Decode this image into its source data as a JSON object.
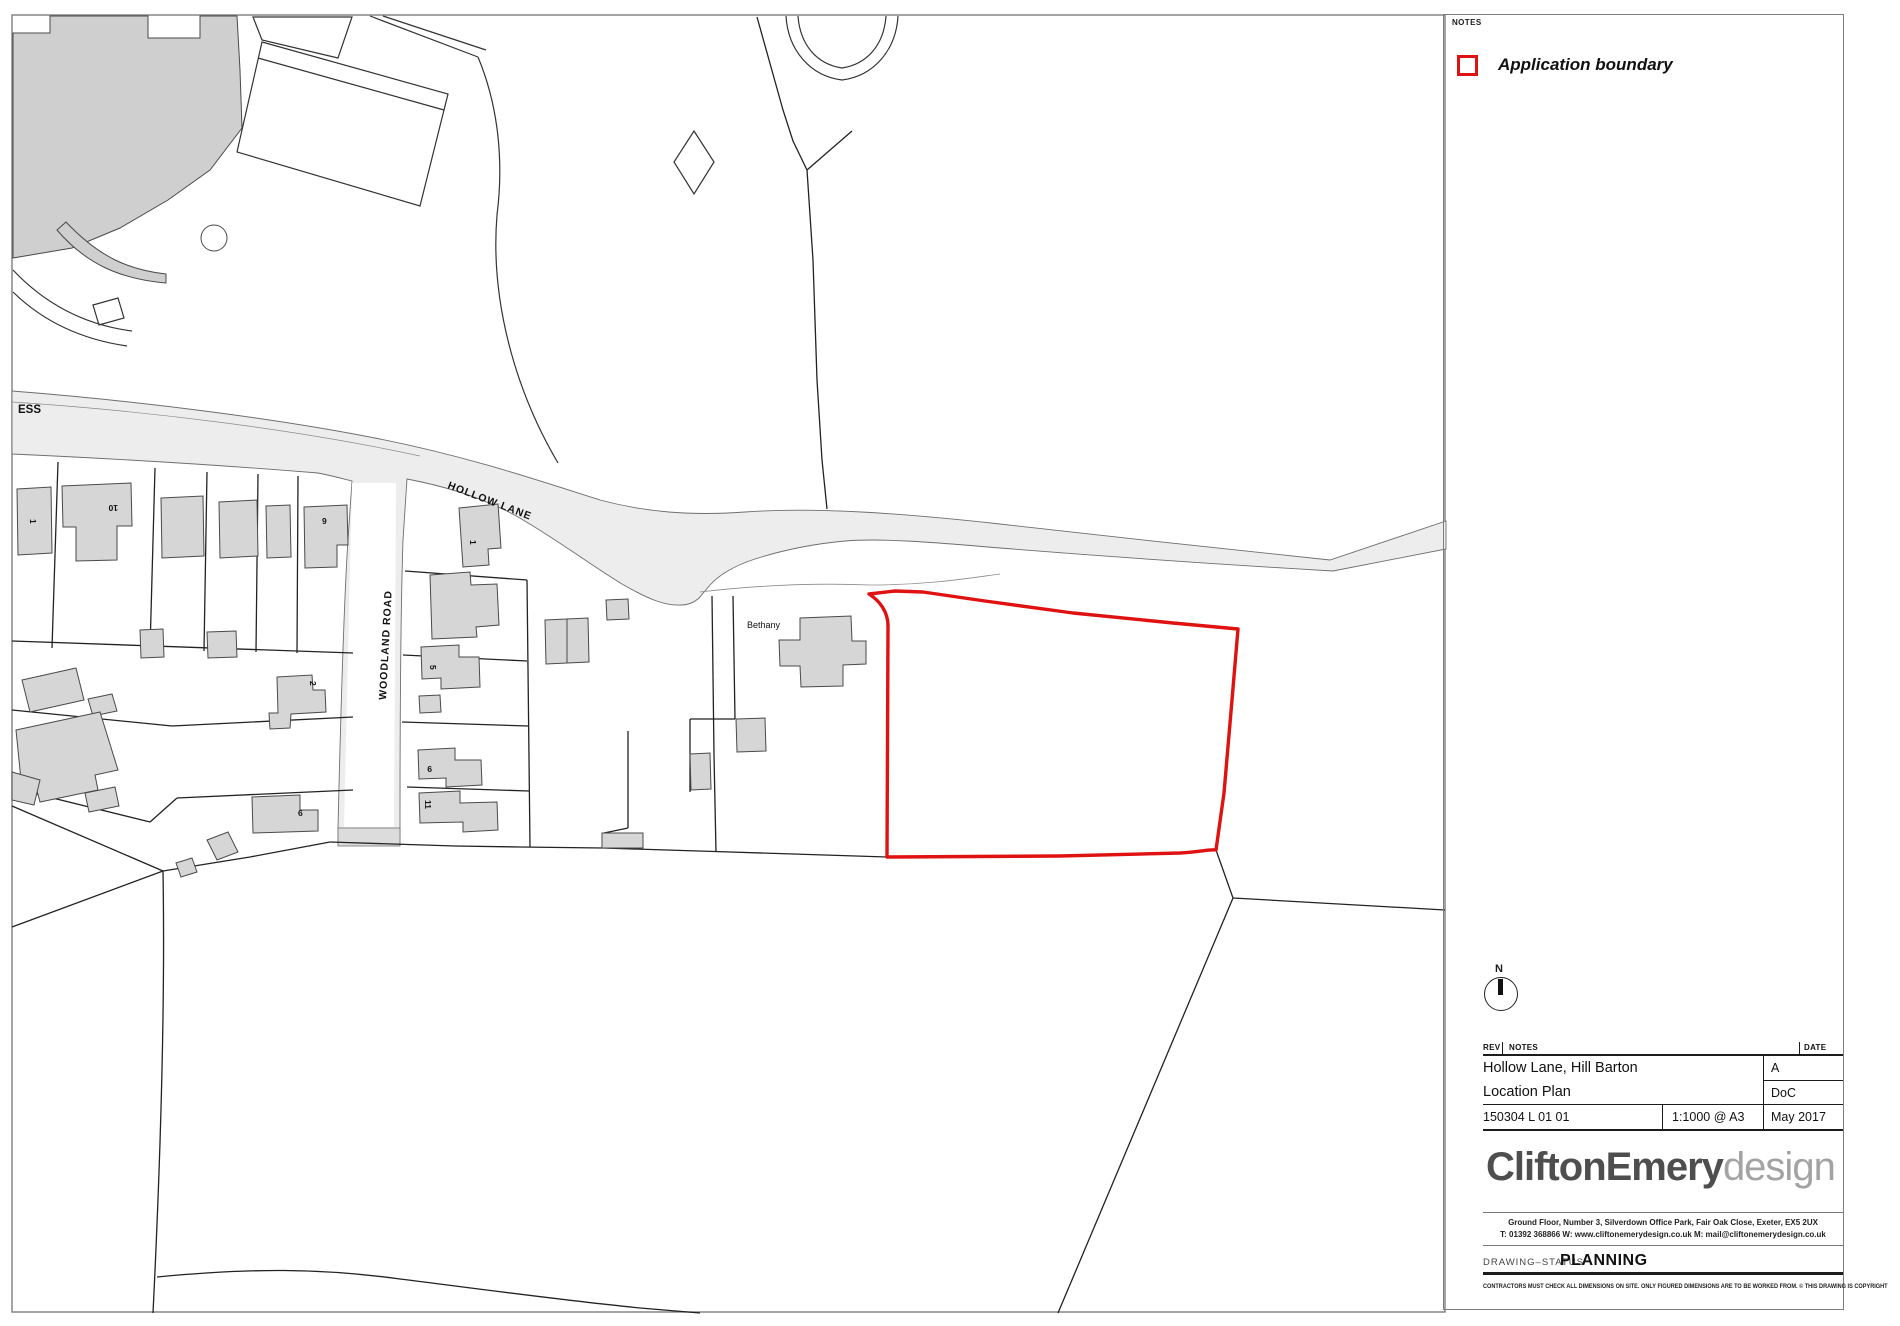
{
  "map": {
    "labels": {
      "ess": "ESS",
      "hollow_lane": "HOLLOW LANE",
      "woodland_road": "WOODLAND ROAD",
      "bethany": "Bethany"
    },
    "house_numbers": {
      "r1a": "1",
      "r1b": "10",
      "r1c": "9",
      "e1": "1",
      "e5": "5",
      "e9": "9",
      "e11": "11",
      "w2": "2",
      "w6": "6"
    },
    "colors": {
      "application_boundary": "#e01111",
      "road_fill": "#ededed",
      "building_fill": "#d6d6d6",
      "parcel_line": "#222222"
    }
  },
  "notes_panel": {
    "notes_label": "NOTES",
    "legend": {
      "label": "Application boundary"
    }
  },
  "north_arrow": {
    "label": "N"
  },
  "title_block": {
    "rev_header": "REV",
    "notes_header": "NOTES",
    "date_header": "DATE",
    "project": "Hollow Lane, Hill Barton",
    "drawing_title": "Location Plan",
    "revision": "A",
    "drawn_by": "DoC",
    "drawing_number": "150304 L 01 01",
    "scale": "1:1000 @ A3",
    "date": "May 2017"
  },
  "branding": {
    "logo_primary": "CliftonEmery",
    "logo_secondary": "design",
    "address_line1": "Ground Floor, Number 3, Silverdown Office Park, Fair Oak Close, Exeter, EX5 2UX",
    "address_line2": "T: 01392 368866   W: www.cliftonemerydesign.co.uk   M: mail@cliftonemerydesign.co.uk"
  },
  "status": {
    "label": "DRAWING–STATUS",
    "value": "PLANNING"
  },
  "disclaimer": "CONTRACTORS MUST CHECK ALL DIMENSIONS ON SITE. ONLY FIGURED DIMENSIONS ARE TO BE WORKED FROM. © THIS DRAWING IS COPYRIGHT"
}
